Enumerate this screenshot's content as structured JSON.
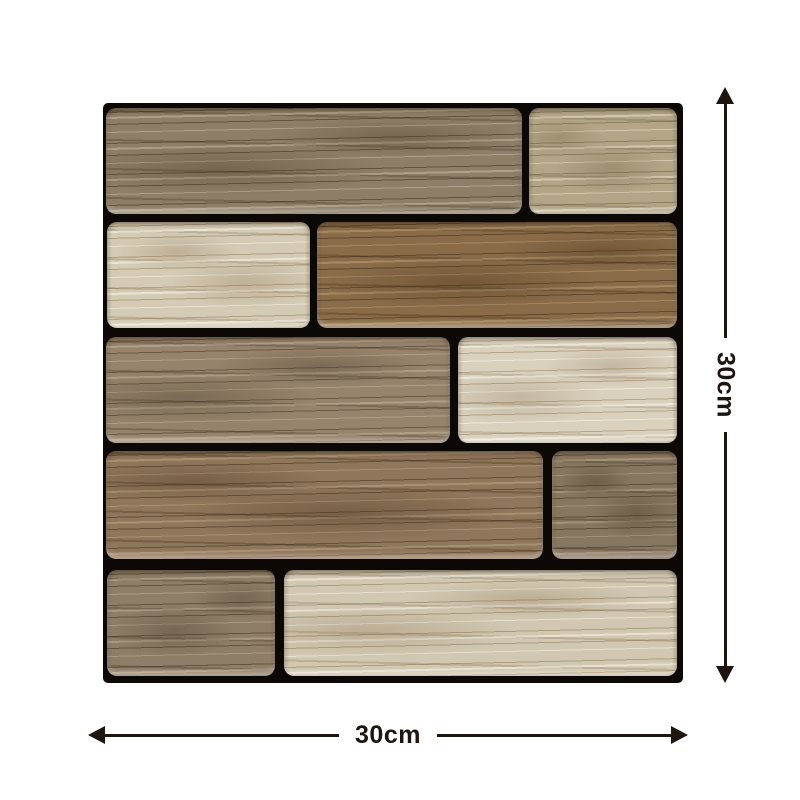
{
  "dimensions": {
    "height_label": "30cm",
    "width_label": "30cm",
    "color": "#1e1410"
  },
  "tile": {
    "x": 103,
    "y": 103,
    "width": 580,
    "height": 580,
    "grout_color": "#0c0805",
    "planks": [
      {
        "name": "plank-row1-left",
        "row": 1,
        "tone": "taupe-brown",
        "x": 3,
        "y": 5,
        "w": 416,
        "h": 106,
        "base": "#8e7e67",
        "grain": "rgba(62,48,32,0.55)",
        "sheen": "rgba(222,208,183,0.40)",
        "swirl": "rgba(74,58,38,0.35)"
      },
      {
        "name": "plank-row1-right",
        "row": 1,
        "tone": "light-tan",
        "x": 426,
        "y": 5,
        "w": 148,
        "h": 106,
        "base": "#b3a687",
        "grain": "rgba(104,86,56,0.50)",
        "sheen": "rgba(240,231,211,0.50)",
        "swirl": "rgba(110,90,60,0.30)"
      },
      {
        "name": "plank-row2-left",
        "row": 2,
        "tone": "cream",
        "x": 4,
        "y": 119,
        "w": 203,
        "h": 106,
        "base": "#d5cbb4",
        "grain": "rgba(138,116,84,0.50)",
        "sheen": "rgba(248,244,232,0.60)",
        "swirl": "rgba(138,116,84,0.30)"
      },
      {
        "name": "plank-row2-right",
        "row": 2,
        "tone": "warm-brown",
        "x": 214,
        "y": 119,
        "w": 360,
        "h": 106,
        "base": "#8a6c48",
        "grain": "rgba(66,46,24,0.55)",
        "sheen": "rgba(196,170,134,0.45)",
        "swirl": "rgba(70,50,28,0.35)"
      },
      {
        "name": "plank-row3-left",
        "row": 3,
        "tone": "taupe-brown",
        "x": 3,
        "y": 234,
        "w": 344,
        "h": 106,
        "base": "#95836b",
        "grain": "rgba(70,56,38,0.55)",
        "sheen": "rgba(214,199,174,0.40)",
        "swirl": "rgba(76,61,41,0.35)"
      },
      {
        "name": "plank-row3-right",
        "row": 3,
        "tone": "cream",
        "x": 355,
        "y": 234,
        "w": 219,
        "h": 106,
        "base": "#d9d0bd",
        "grain": "rgba(142,120,88,0.50)",
        "sheen": "rgba(250,246,236,0.60)",
        "swirl": "rgba(142,120,88,0.28)"
      },
      {
        "name": "plank-row4-left",
        "row": 4,
        "tone": "warm-brown",
        "x": 3,
        "y": 348,
        "w": 437,
        "h": 108,
        "base": "#90765a",
        "grain": "rgba(68,48,26,0.55)",
        "sheen": "rgba(200,176,142,0.45)",
        "swirl": "rgba(72,52,30,0.35)"
      },
      {
        "name": "plank-row4-right",
        "row": 4,
        "tone": "gray-brown",
        "x": 449,
        "y": 348,
        "w": 125,
        "h": 108,
        "base": "#887760",
        "grain": "rgba(60,48,30,0.55)",
        "sheen": "rgba(200,186,158,0.40)",
        "swirl": "rgba(64,52,34,0.35)"
      },
      {
        "name": "plank-row5-left",
        "row": 5,
        "tone": "taupe-brown",
        "x": 4,
        "y": 467,
        "w": 168,
        "h": 106,
        "base": "#8e7d67",
        "grain": "rgba(62,50,33,0.55)",
        "sheen": "rgba(210,196,172,0.40)",
        "swirl": "rgba(70,57,38,0.33)"
      },
      {
        "name": "plank-row5-right",
        "row": 5,
        "tone": "cream",
        "x": 181,
        "y": 467,
        "w": 393,
        "h": 106,
        "base": "#d2c8b1",
        "grain": "rgba(134,112,80,0.50)",
        "sheen": "rgba(246,241,229,0.60)",
        "swirl": "rgba(134,112,80,0.30)"
      }
    ]
  }
}
